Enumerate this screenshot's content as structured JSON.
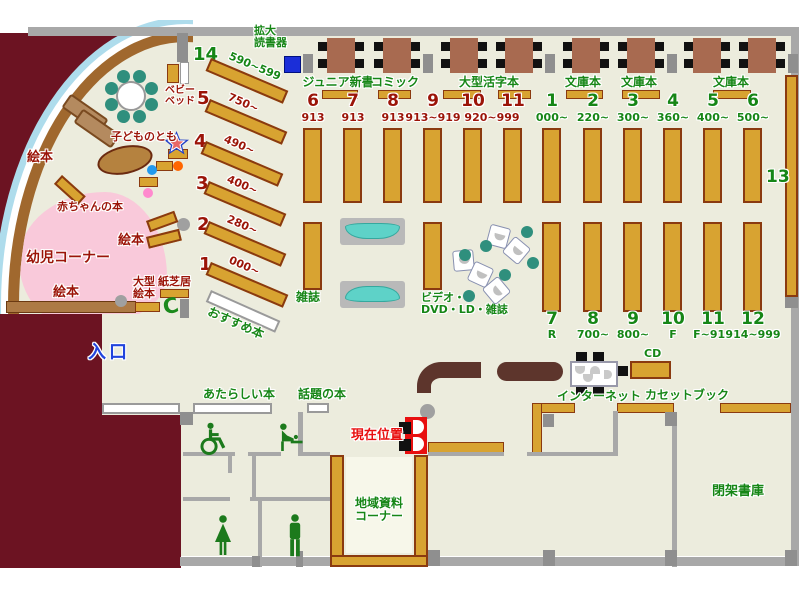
{
  "colors": {
    "floor": "#ececdd",
    "wall": "#a8a8a8",
    "outside": "#6c1322",
    "gold": "#d8a331",
    "goldb": "#8a3a10",
    "counter": "#5d352c",
    "table": "#a86a50",
    "teal": "#2f8f7d",
    "pink": "#f9c9da",
    "accent_green": "#168616",
    "accent_red": "#9b1408",
    "accent_blue": "#2244dd",
    "marker_red": "#e80f0f",
    "arc_brown": "#a0682e",
    "arc_blue": "#aedcec",
    "magnifier_blue": "#1b2ed8"
  },
  "children_corner": {
    "picture_books_top": "絵本",
    "picture_books_mid": "絵本",
    "picture_books_bottom": "絵本",
    "baby_books": "赤ちゃんの本",
    "infant_corner": "幼児コーナー",
    "kodomo_no_tomo": "子どものとも",
    "baby_bed_line1": "ベビー",
    "baby_bed_line2": "ベッド",
    "large_picture_line1": "大型",
    "large_picture_line2": "絵本",
    "kamishibai": "紙芝居"
  },
  "entrance_label": "入口",
  "recommended_label": "おすすめ本",
  "magnifier": {
    "line1": "拡大",
    "line2": "読書器"
  },
  "left_shelves": [
    {
      "no": "14",
      "range": "590~599",
      "accent": "green"
    },
    {
      "no": "5",
      "range": "750~",
      "accent": "red"
    },
    {
      "no": "4",
      "range": "490~",
      "accent": "red"
    },
    {
      "no": "3",
      "range": "400~",
      "accent": "red"
    },
    {
      "no": "2",
      "range": "280~",
      "accent": "red"
    },
    {
      "no": "1",
      "range": "000~",
      "accent": "red"
    }
  ],
  "sections": [
    {
      "label": "ジュニア新書"
    },
    {
      "label": "コミック"
    },
    {
      "label": "大型活字本"
    },
    {
      "label": "文庫本"
    },
    {
      "label": "文庫本"
    },
    {
      "label": "文庫本"
    }
  ],
  "upper_shelves": [
    {
      "no": "6",
      "range": "913",
      "accent": "red"
    },
    {
      "no": "7",
      "range": "913",
      "accent": "red"
    },
    {
      "no": "8",
      "range": "913",
      "accent": "red"
    },
    {
      "no": "9",
      "range": "913~919",
      "accent": "red"
    },
    {
      "no": "10",
      "range": "920~999",
      "accent": "red"
    },
    {
      "no": "11",
      "range": "",
      "accent": "red"
    },
    {
      "no": "1",
      "range": "000~",
      "accent": "green"
    },
    {
      "no": "2",
      "range": "220~",
      "accent": "green"
    },
    {
      "no": "3",
      "range": "300~",
      "accent": "green"
    },
    {
      "no": "4",
      "range": "360~",
      "accent": "green"
    },
    {
      "no": "5",
      "range": "400~",
      "accent": "green"
    },
    {
      "no": "6",
      "range": "500~",
      "accent": "green"
    }
  ],
  "lower_shelves": [
    {
      "no": "7",
      "range": "R"
    },
    {
      "no": "8",
      "range": "700~"
    },
    {
      "no": "9",
      "range": "800~"
    },
    {
      "no": "10",
      "range": "F"
    },
    {
      "no": "11",
      "range": "F~914"
    },
    {
      "no": "12",
      "range": "914~999"
    }
  ],
  "shelf13_label": "13",
  "magazines_label": "雑誌",
  "video_corner": {
    "line1": "ビデオ・",
    "line2": "DVD・LD・雑誌"
  },
  "new_books_label": "あたらしい本",
  "topic_books_label": "話題の本",
  "current_position_label": "現在位置",
  "local_materials": {
    "line1": "地域資料",
    "line2": "コーナー"
  },
  "internet_label": "インターネット",
  "cd_label": "CD",
  "cassette_label": "カセットブック",
  "closed_stacks_label": "閉架書庫",
  "phone_label": "C"
}
